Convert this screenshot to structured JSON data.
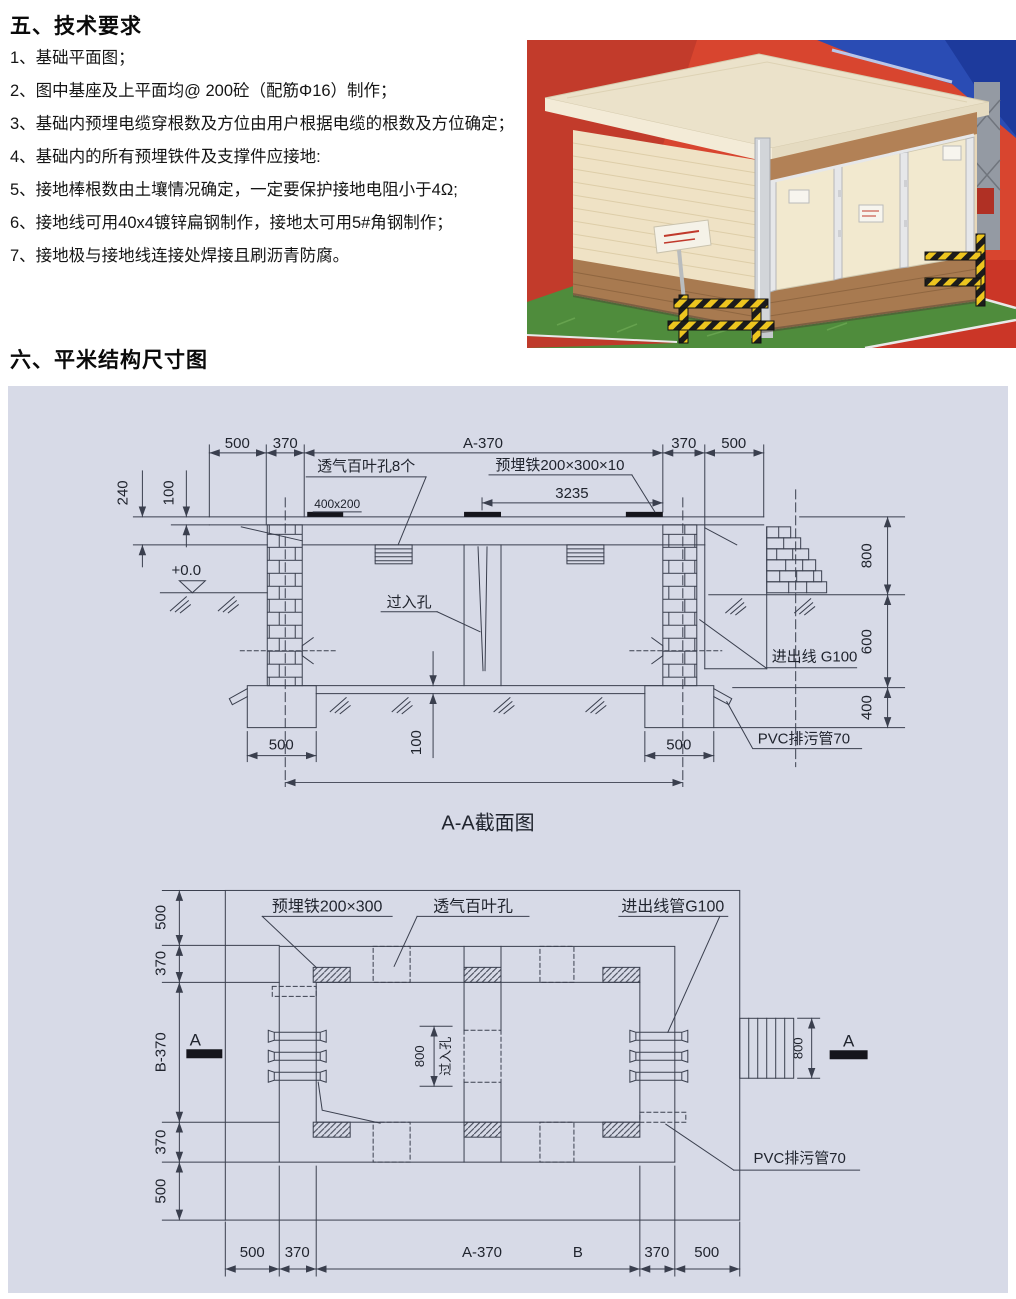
{
  "page": {
    "section5_title": "五、技术要求",
    "items": [
      "1、基础平面图；",
      "2、图中基座及上平面均@ 200砼（配筋Φ16）制作；",
      "3、基础内预埋电缆穿根数及方位由用户根据电缆的根数及方位确定；",
      "4、基础内的所有预埋铁件及支撑件应接地:",
      "5、接地棒根数由土壤情况确定，一定要保护接地电阻小于4Ω;",
      "6、接地线可用40x4镀锌扁钢制作，接地太可用5#角钢制作；",
      "7、接地极与接地线连接处焊接且刷沥青防腐。"
    ],
    "section6_title": "六、平米结构尺寸图"
  },
  "section_view": {
    "title": "A-A截面图",
    "top_dims": [
      "500",
      "370",
      "A-370",
      "370",
      "500"
    ],
    "left_dims": [
      "240",
      "100"
    ],
    "level": "+0.0",
    "louver": "透气百叶孔8个",
    "plate_size": "400x200",
    "embed": "预埋铁200×300×10",
    "span": "3235",
    "hole": "过入孔",
    "inout": "进出线 G100",
    "right_dims": [
      "800",
      "600",
      "400"
    ],
    "footing_dims": [
      "500",
      "500"
    ],
    "slab_dim": "100",
    "pvc": "PVC排污管70"
  },
  "plan_view": {
    "left_dims": [
      "500",
      "370",
      "B-370",
      "370",
      "500"
    ],
    "embed": "预埋铁200×300",
    "louver": "透气百叶孔",
    "inout": "进出线管G100",
    "center_dim": "800",
    "hole": "过入孔",
    "marker_left": "A",
    "marker_right": "A",
    "right_dim": "800",
    "pvc": "PVC排污管70",
    "bottom_dims": [
      "500",
      "370",
      "A-370",
      "B",
      "370",
      "500"
    ]
  }
}
